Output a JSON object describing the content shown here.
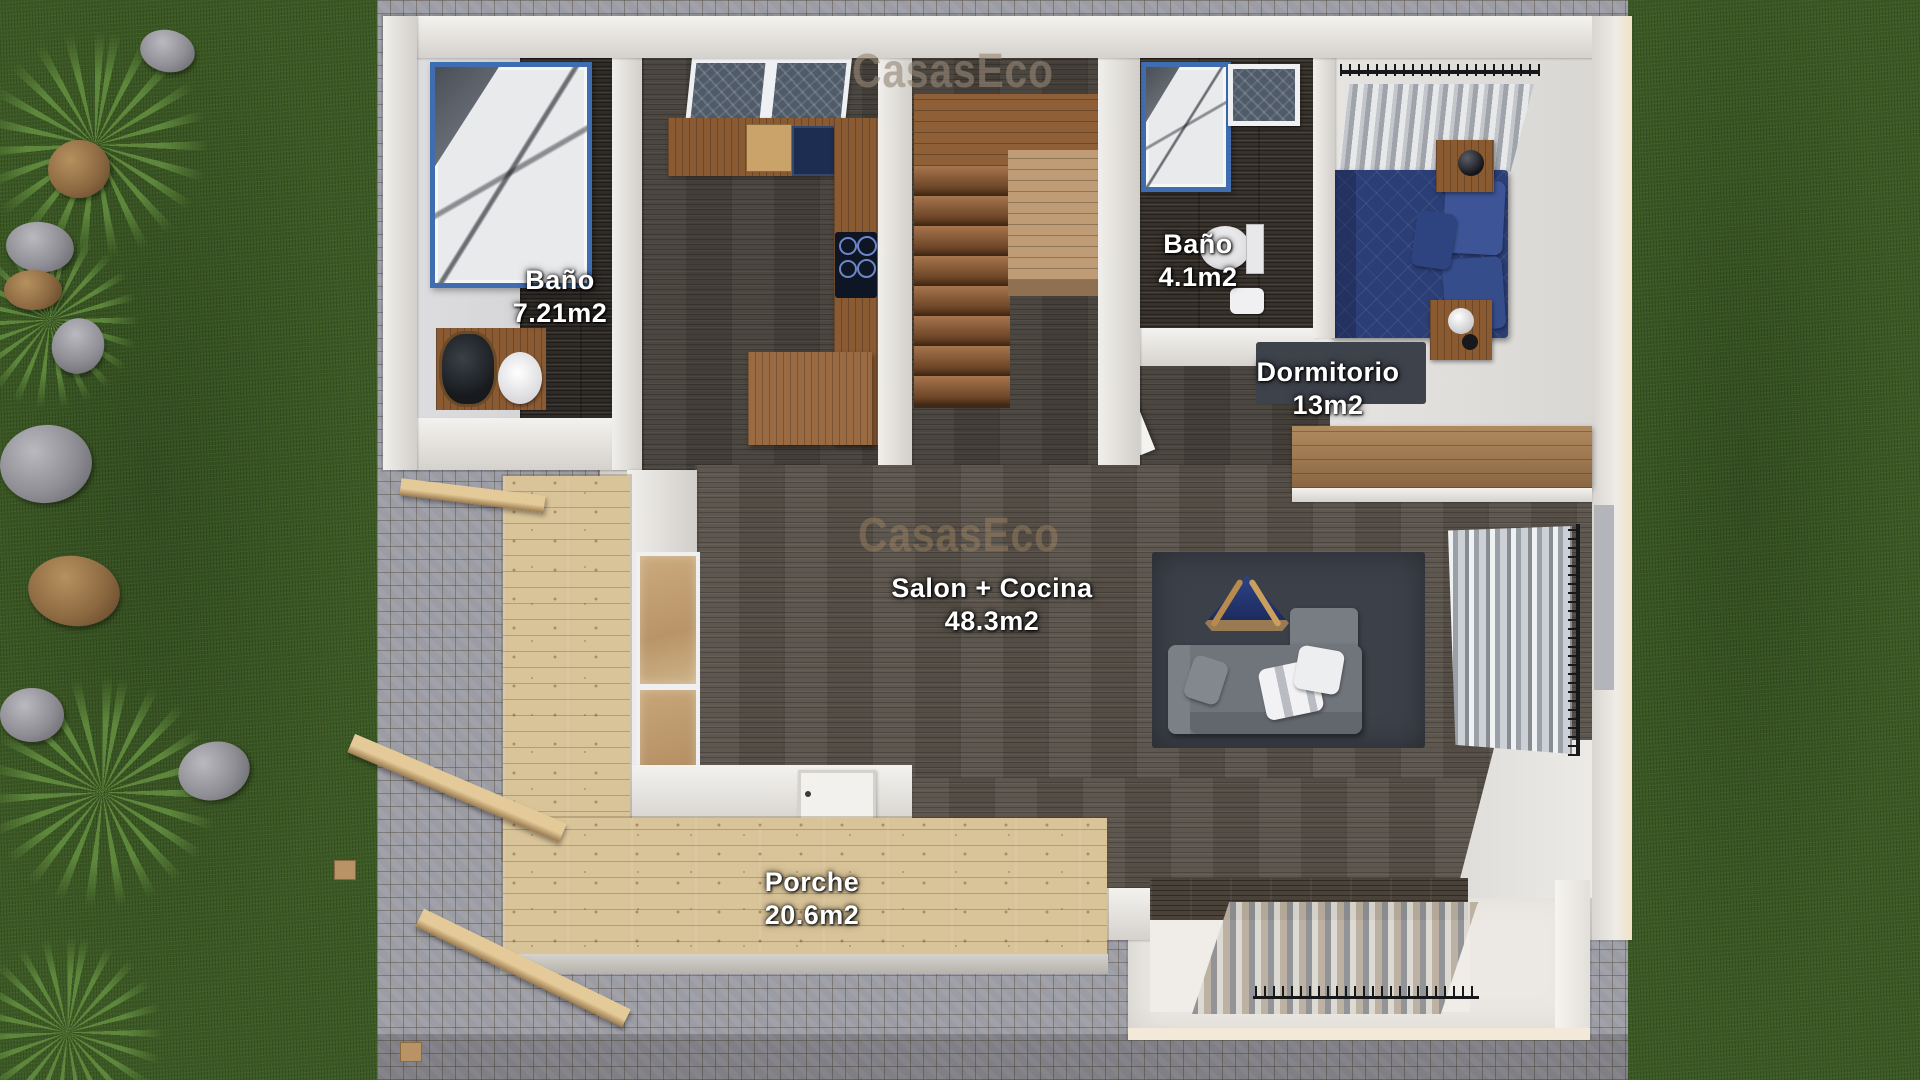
{
  "watermark": {
    "text": "CasasEco"
  },
  "rooms": {
    "bath1": {
      "name": "Baño",
      "area": "7.21m2"
    },
    "bath2": {
      "name": "Baño",
      "area": "4.1m2"
    },
    "bedroom": {
      "name": "Dormitorio",
      "area": "13m2"
    },
    "salon": {
      "name": "Salon + Cocina",
      "area": "48.3m2"
    },
    "porch": {
      "name": "Porche",
      "area": "20.6m2"
    }
  },
  "colors": {
    "grass": "#3c5a24",
    "cobblestone": "#9b9ca4",
    "wall_white": "#e5e2de",
    "floor_dark_plank": "#59524a",
    "deck_wood": "#d9c499",
    "counter_wood": "#8a5a33",
    "bed_blue": "#2b3e76",
    "shower_frame_blue": "#3f6db0",
    "label_text": "#ffffff"
  }
}
